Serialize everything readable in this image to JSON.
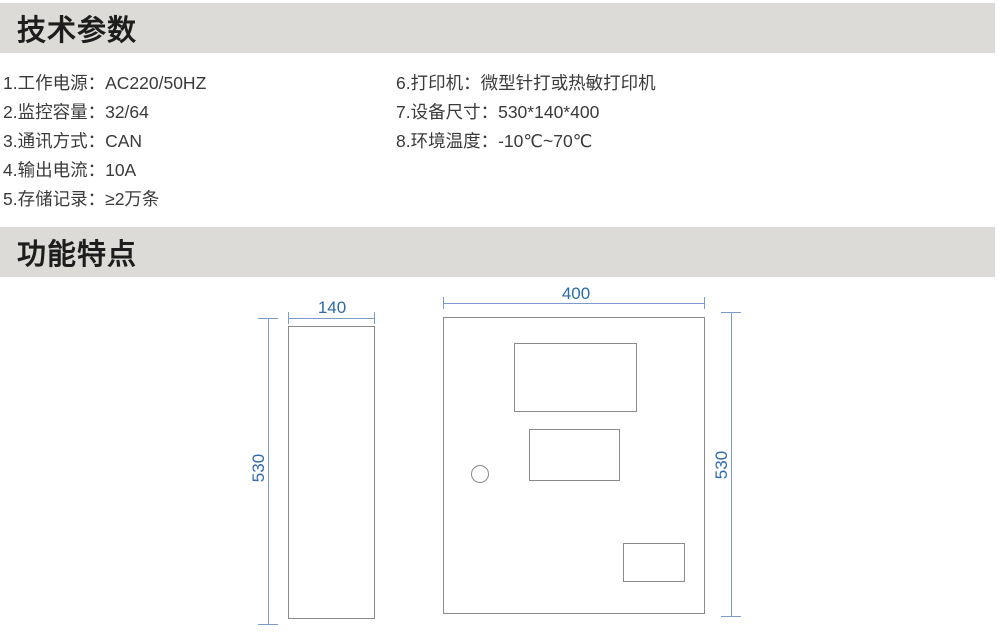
{
  "sections": {
    "tech_params": {
      "title": "技术参数"
    },
    "features": {
      "title": "功能特点"
    }
  },
  "specs": {
    "left": [
      "1.工作电源：AC220/50HZ",
      "2.监控容量：32/64",
      "3.通讯方式：CAN",
      "4.输出电流：10A",
      "5.存储记录：≥2万条"
    ],
    "right": [
      "6.打印机：微型针打或热敏打印机",
      "7.设备尺寸：530*140*400",
      "8.环境温度：-10℃~70℃"
    ]
  },
  "drawing": {
    "side_view": {
      "width_label": "140",
      "height_label": "530"
    },
    "front_view": {
      "width_label": "400",
      "height_label": "530"
    }
  },
  "colors": {
    "header_bg": "#dcdbd8",
    "dimension_text_blue": "#2d6aab",
    "dimension_line_blue": "#7b9cc9",
    "outline_gray": "#8a8a8a"
  }
}
